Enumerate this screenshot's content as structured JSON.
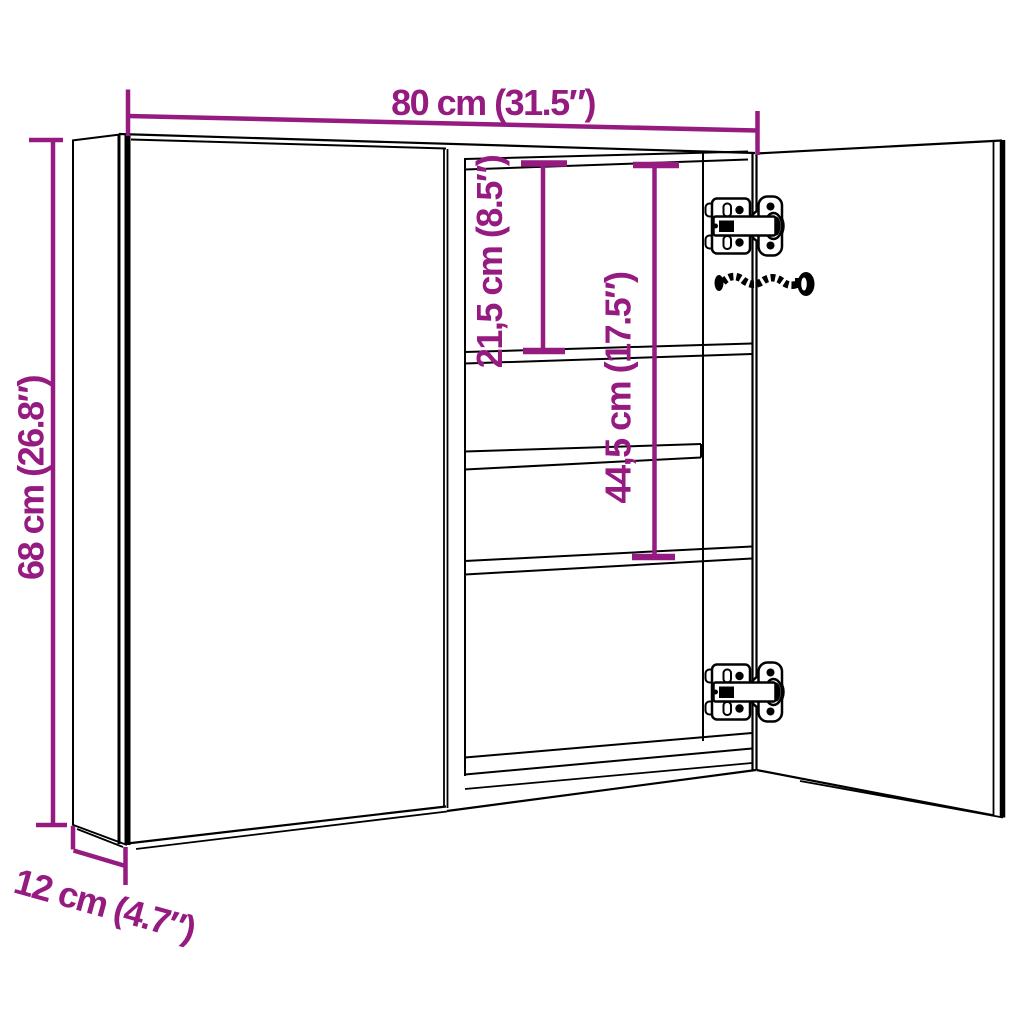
{
  "diagram": {
    "type": "product-dimension-diagram",
    "colors": {
      "dimension_accent": "#951B81",
      "line": "#000000",
      "background": "#FFFFFF"
    },
    "dimensions": {
      "width": {
        "label": "80 cm (31.5″)"
      },
      "height": {
        "label": "68 cm (26.8″)"
      },
      "depth": {
        "label": "12 cm (4.7″)"
      },
      "inner_top_shelf": {
        "label": "21,5 cm (8.5″)"
      },
      "inner_span": {
        "label": "44,5 cm (17.5″)"
      }
    },
    "icons": {
      "hinge_top": "concealed-cup-hinge-icon",
      "hinge_bottom": "concealed-cup-hinge-icon",
      "power_cord": "power-cord-icon"
    }
  }
}
